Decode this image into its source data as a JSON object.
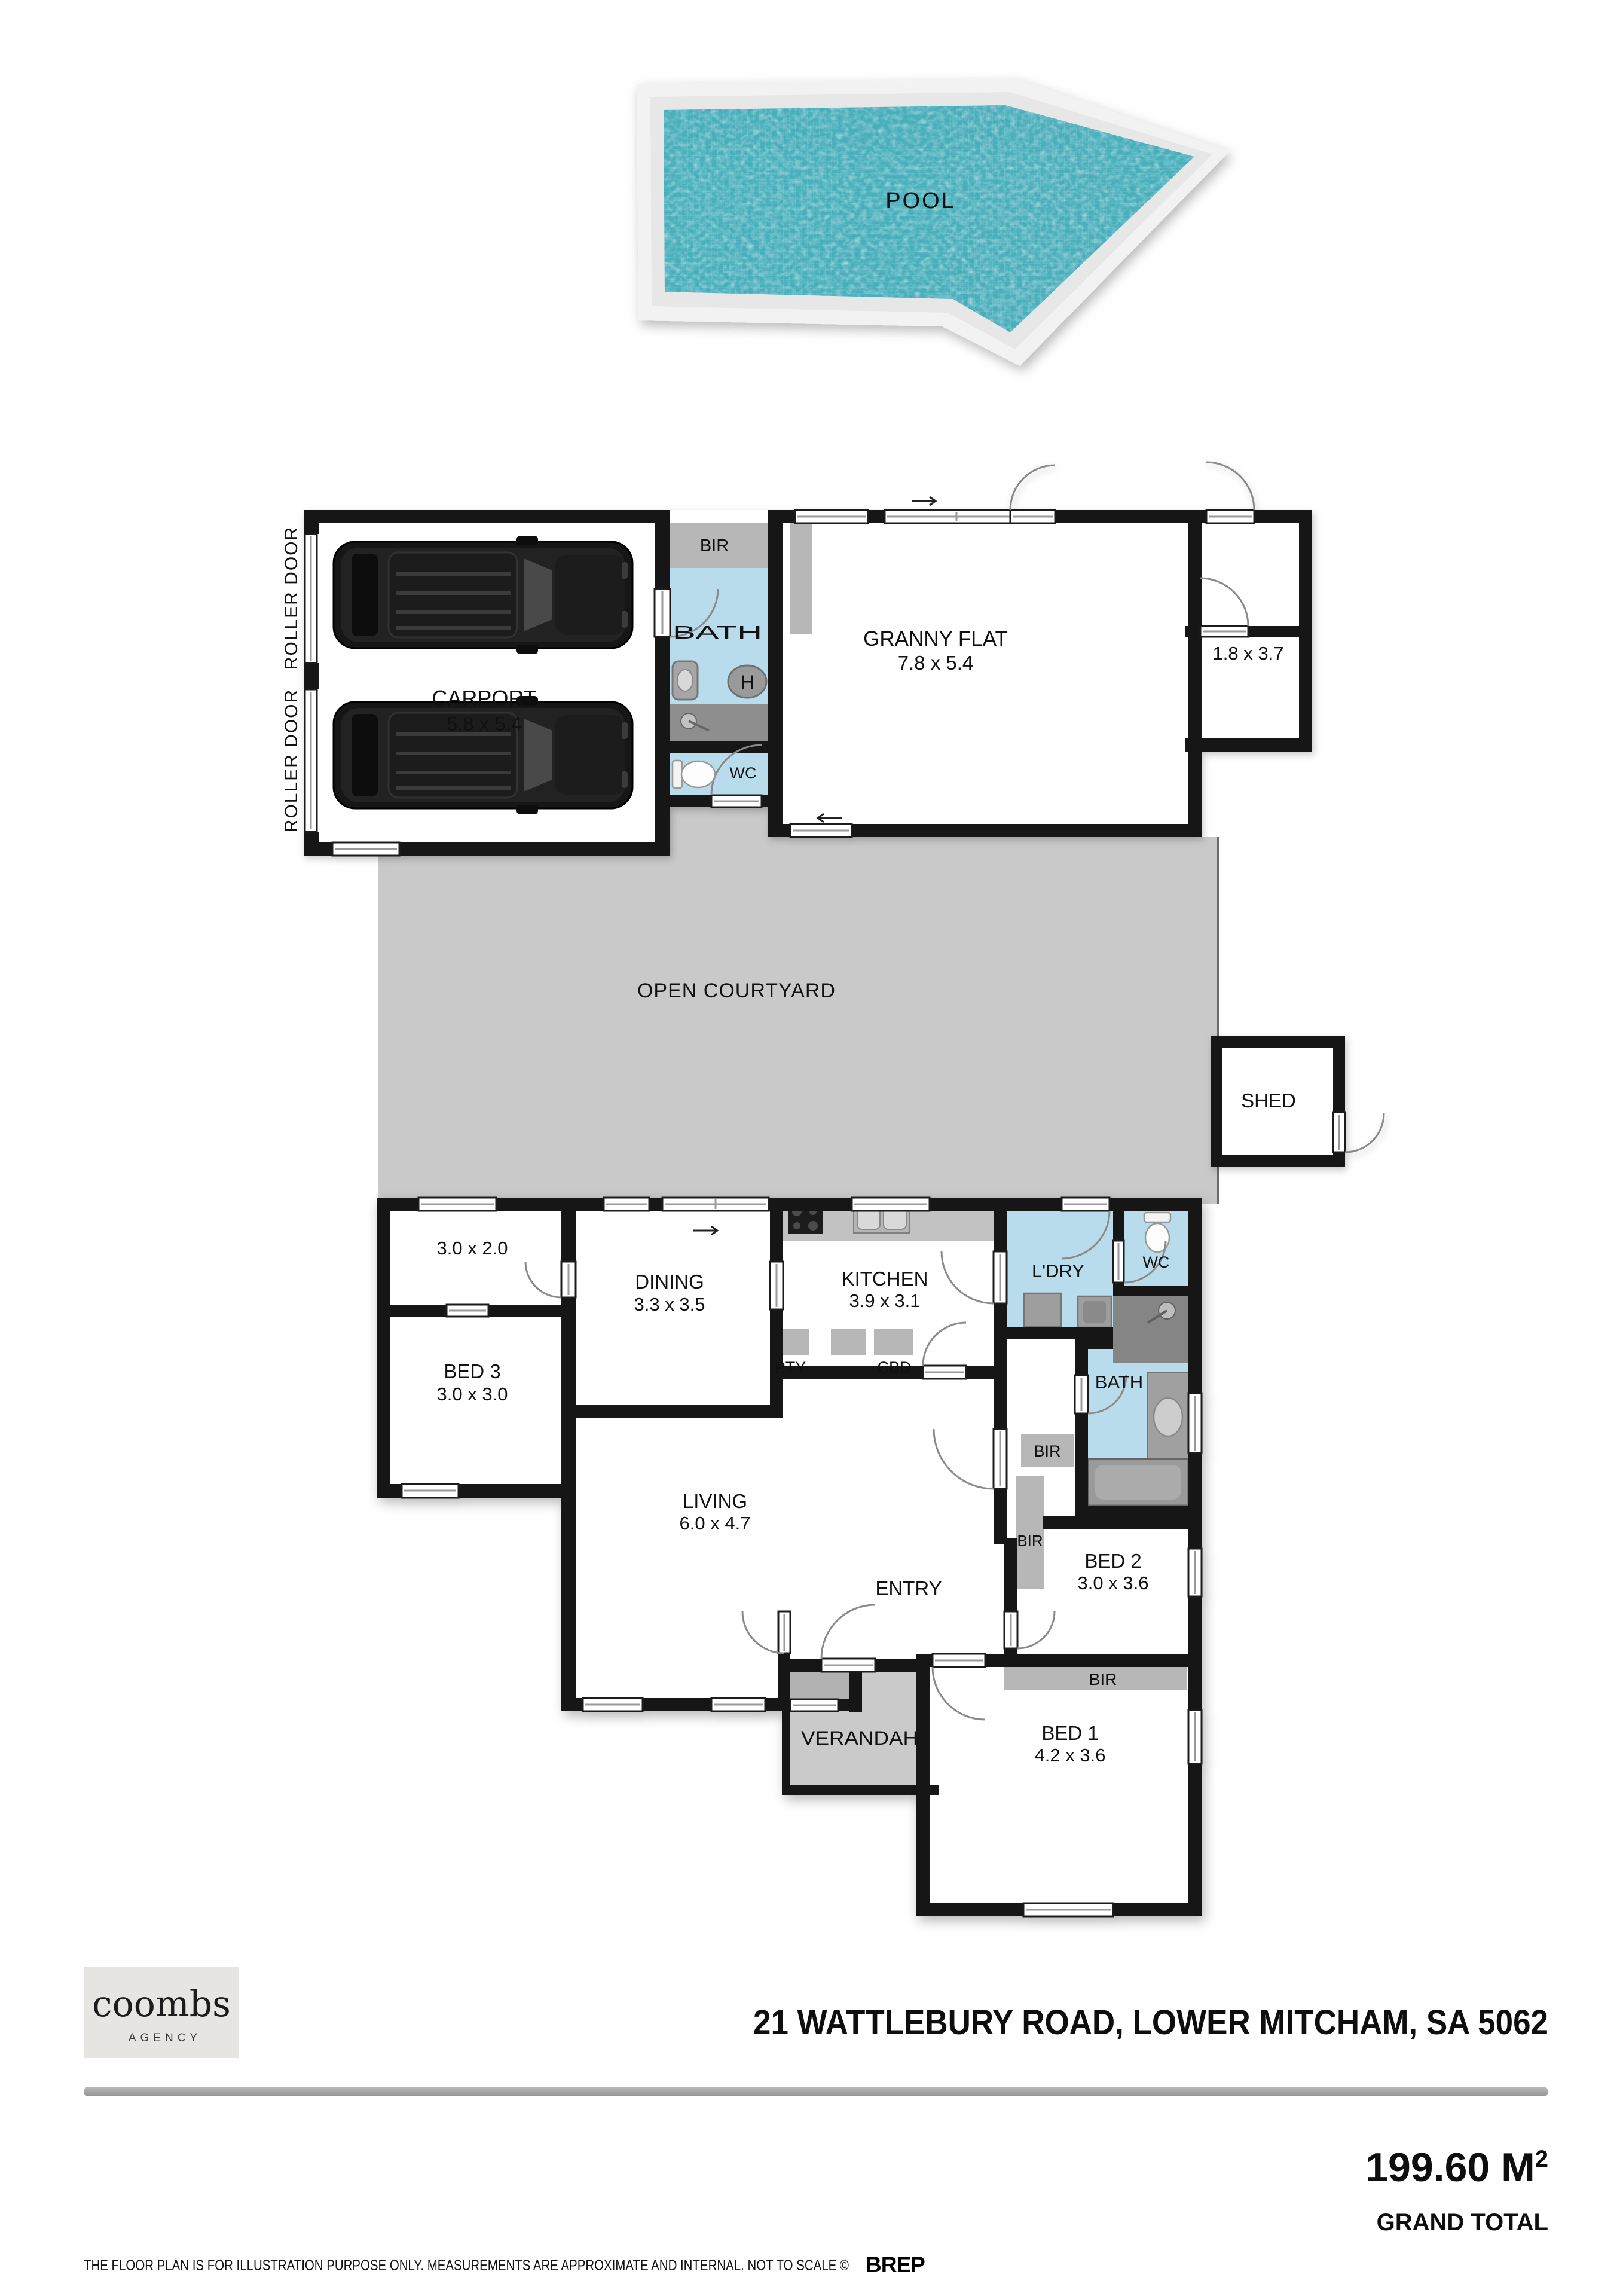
{
  "pool": {
    "label": "POOL"
  },
  "carport": {
    "label": "CARPORT",
    "dims": "5.8 x 5.4",
    "roller_door": "ROLLER DOOR"
  },
  "ensuite": {
    "bir": "BIR",
    "bath": "BATH",
    "hot_water": "H",
    "wc": "WC"
  },
  "granny_flat": {
    "label": "GRANNY FLAT",
    "dims": "7.8 x 5.4"
  },
  "side_room": {
    "dims": "1.8 x 3.7"
  },
  "courtyard": {
    "label": "OPEN COURTYARD"
  },
  "shed": {
    "label": "SHED"
  },
  "house": {
    "store": {
      "dims": "3.0 x 2.0"
    },
    "bed3": {
      "label": "BED 3",
      "dims": "3.0 x 3.0"
    },
    "dining": {
      "label": "DINING",
      "dims": "3.3 x 3.5"
    },
    "kitchen": {
      "label": "KITCHEN",
      "dims": "3.9 x 3.1"
    },
    "pantry": {
      "label": "PTY"
    },
    "cupboard": {
      "label": "CBD"
    },
    "laundry": {
      "label": "L'DRY"
    },
    "wc": {
      "label": "WC"
    },
    "bath": {
      "label": "BATH"
    },
    "bir": {
      "label": "BIR"
    },
    "living": {
      "label": "LIVING",
      "dims": "6.0 x 4.7"
    },
    "entry": {
      "label": "ENTRY"
    },
    "verandah": {
      "label": "VERANDAH"
    },
    "bed2": {
      "label": "BED 2",
      "dims": "3.0 x 3.6"
    },
    "bed1": {
      "label": "BED 1",
      "dims": "4.2 x 3.6"
    }
  },
  "footer": {
    "agency_name": "coombs",
    "agency_sub": "AGENCY",
    "address": "21 WATTLEBURY ROAD, LOWER MITCHAM, SA 5062",
    "area_value": "199.60 M",
    "area_sup": "2",
    "area_label": "GRAND TOTAL",
    "disclaimer": "THE FLOOR PLAN IS FOR ILLUSTRATION PURPOSE ONLY. MEASUREMENTS ARE APPROXIMATE AND INTERNAL. NOT TO SCALE ©",
    "brand": "BREP"
  }
}
